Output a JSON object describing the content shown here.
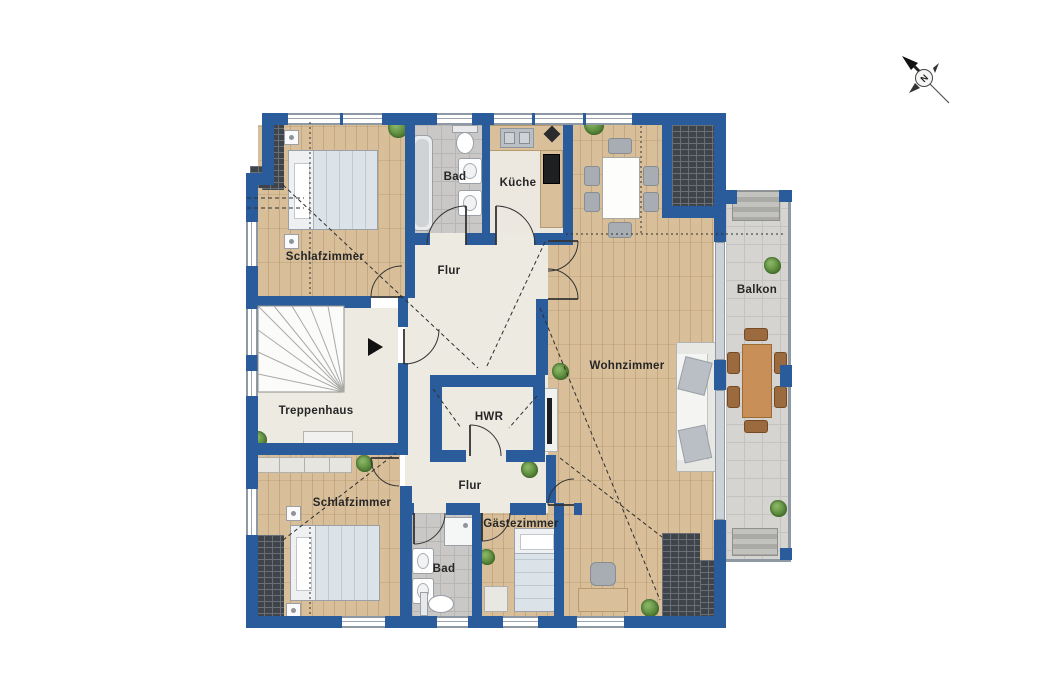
{
  "compass": {
    "label": "N"
  },
  "rooms": [
    {
      "id": "schlafzimmer-1",
      "label": "Schlafzimmer"
    },
    {
      "id": "bad-1",
      "label": "Bad"
    },
    {
      "id": "kueche",
      "label": "Küche"
    },
    {
      "id": "flur-1",
      "label": "Flur"
    },
    {
      "id": "wohnzimmer",
      "label": "Wohnzimmer"
    },
    {
      "id": "balkon",
      "label": "Balkon"
    },
    {
      "id": "treppenhaus",
      "label": "Treppenhaus"
    },
    {
      "id": "hwr",
      "label": "HWR"
    },
    {
      "id": "flur-2",
      "label": "Flur"
    },
    {
      "id": "schlafzimmer-2",
      "label": "Schlafzimmer"
    },
    {
      "id": "bad-2",
      "label": "Bad"
    },
    {
      "id": "gaestezimmer",
      "label": "Gästezimmer"
    }
  ],
  "colors": {
    "wall": "#2a5c9c",
    "wood_floor": "#d6bc95",
    "hall_floor": "#edeae2",
    "bath_tile": "#c9c8c6",
    "balcony_tile": "#d5d4d0",
    "roof_hatch": "#3f434a"
  }
}
